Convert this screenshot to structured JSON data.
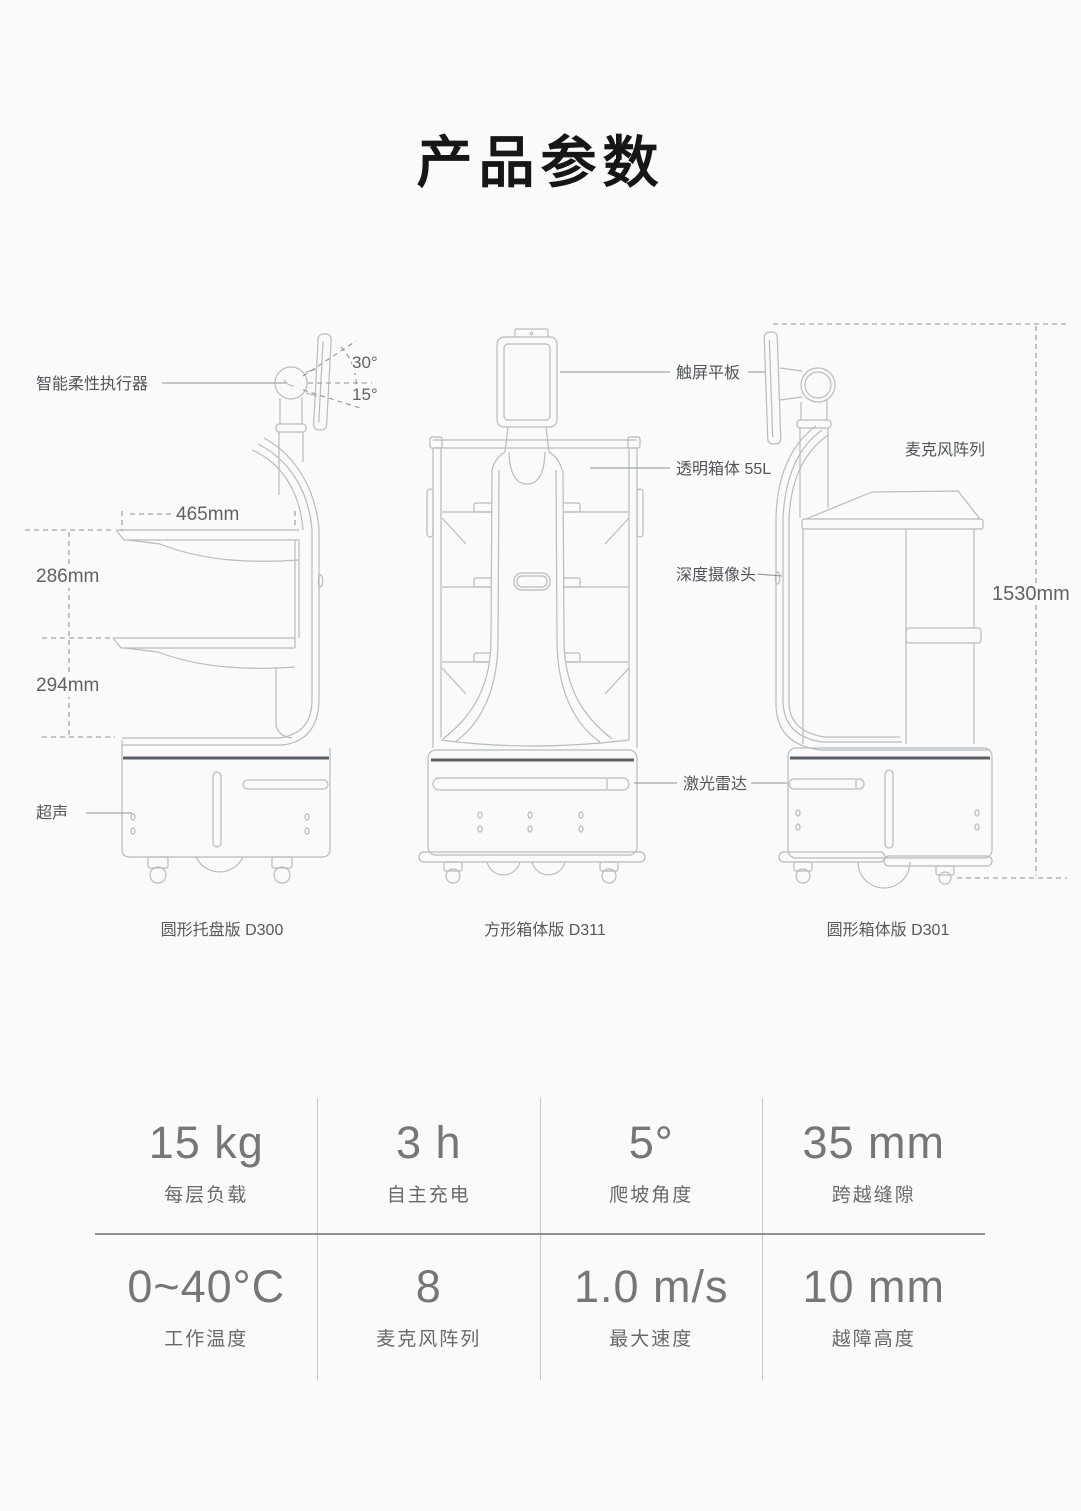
{
  "page": {
    "title": "产品参数"
  },
  "diagram": {
    "labels": {
      "actuator": "智能柔性执行器",
      "touch_tablet": "触屏平板",
      "transparent_box": "透明箱体 55L",
      "depth_camera": "深度摄像头",
      "lidar": "激光雷达",
      "ultrasonic": "超声",
      "mic_array": "麦克风阵列"
    },
    "dimensions": {
      "screen_tilt_up": "30°",
      "screen_tilt_down": "15°",
      "tray_width": "465mm",
      "upper_tray_spacing": "286mm",
      "lower_tray_spacing": "294mm",
      "overall_height": "1530mm"
    },
    "model_captions": [
      {
        "name": "圆形托盘版 D300"
      },
      {
        "name": "方形箱体版 D311"
      },
      {
        "name": "圆形箱体版 D301"
      }
    ]
  },
  "specs": {
    "cells": [
      {
        "value": "15 kg",
        "label": "每层负载"
      },
      {
        "value": "3 h",
        "label": "自主充电"
      },
      {
        "value": "5°",
        "label": "爬坡角度"
      },
      {
        "value": "35 mm",
        "label": "跨越缝隙"
      },
      {
        "value": "0~40°C",
        "label": "工作温度"
      },
      {
        "value": "8",
        "label": "麦克风阵列"
      },
      {
        "value": "1.0 m/s",
        "label": "最大速度"
      },
      {
        "value": "10 mm",
        "label": "越障高度"
      }
    ]
  },
  "colors": {
    "background": "#fafafa",
    "line_art": "#b6bcbf",
    "dark_band": "#5a6064",
    "spec_value": "#767676",
    "spec_label": "#67696b"
  }
}
